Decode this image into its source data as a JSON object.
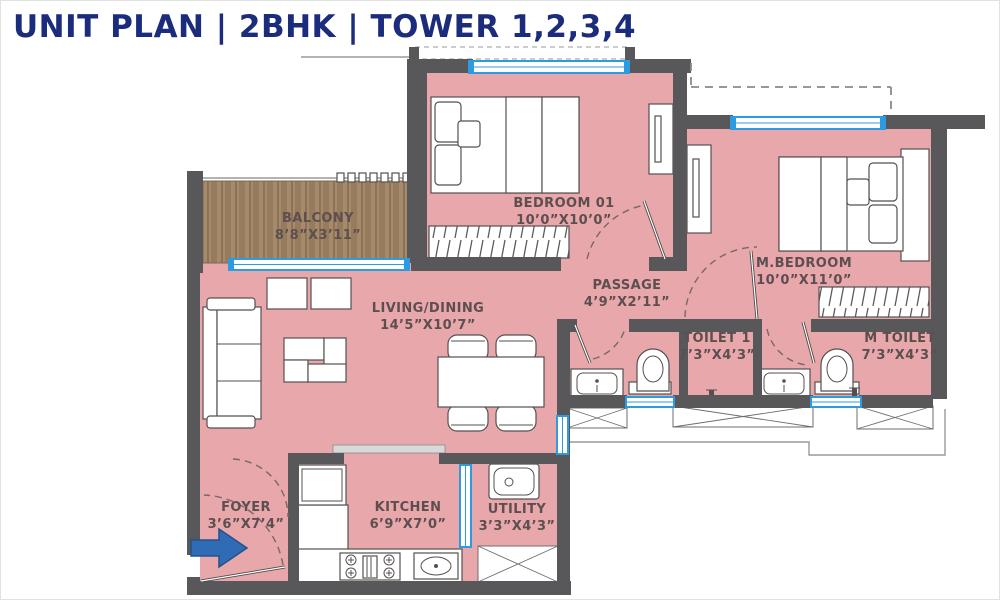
{
  "title": "UNIT PLAN | 2BHK | TOWER 1,2,3,4",
  "rooms": {
    "balcony": {
      "name": "BALCONY",
      "dims": "8’8”X3’11”"
    },
    "bedroom01": {
      "name": "BEDROOM 01",
      "dims": "10’0”X10’0”"
    },
    "master_bedroom": {
      "name": "M.BEDROOM",
      "dims": "10’0”X11’0”"
    },
    "passage": {
      "name": "PASSAGE",
      "dims": "4’9”X2’11”"
    },
    "living_dining": {
      "name": "LIVING/DINING",
      "dims": "14’5”X10’7”"
    },
    "toilet1": {
      "name": "TOILET 1",
      "dims": "7’3”X4’3”"
    },
    "m_toilet": {
      "name": "M TOILET",
      "dims": "7’3”X4’3”"
    },
    "foyer": {
      "name": "FOYER",
      "dims": "3’6”X7’4”"
    },
    "kitchen": {
      "name": "KITCHEN",
      "dims": "6’9”X7’0”"
    },
    "utility": {
      "name": "UTILITY",
      "dims": "3’3”X4’3”"
    }
  },
  "colors": {
    "title_navy": "#1c2c7c",
    "room_pink": "#e7a7ab",
    "wall_gray": "#58575a",
    "wood_brown": "#a58a6b",
    "window_blue": "#2d9be0",
    "label_brown": "#5d4e50",
    "entry_arrow_blue": "#2f6cb5"
  },
  "icons": {
    "entry_arrow": "right-arrow"
  }
}
